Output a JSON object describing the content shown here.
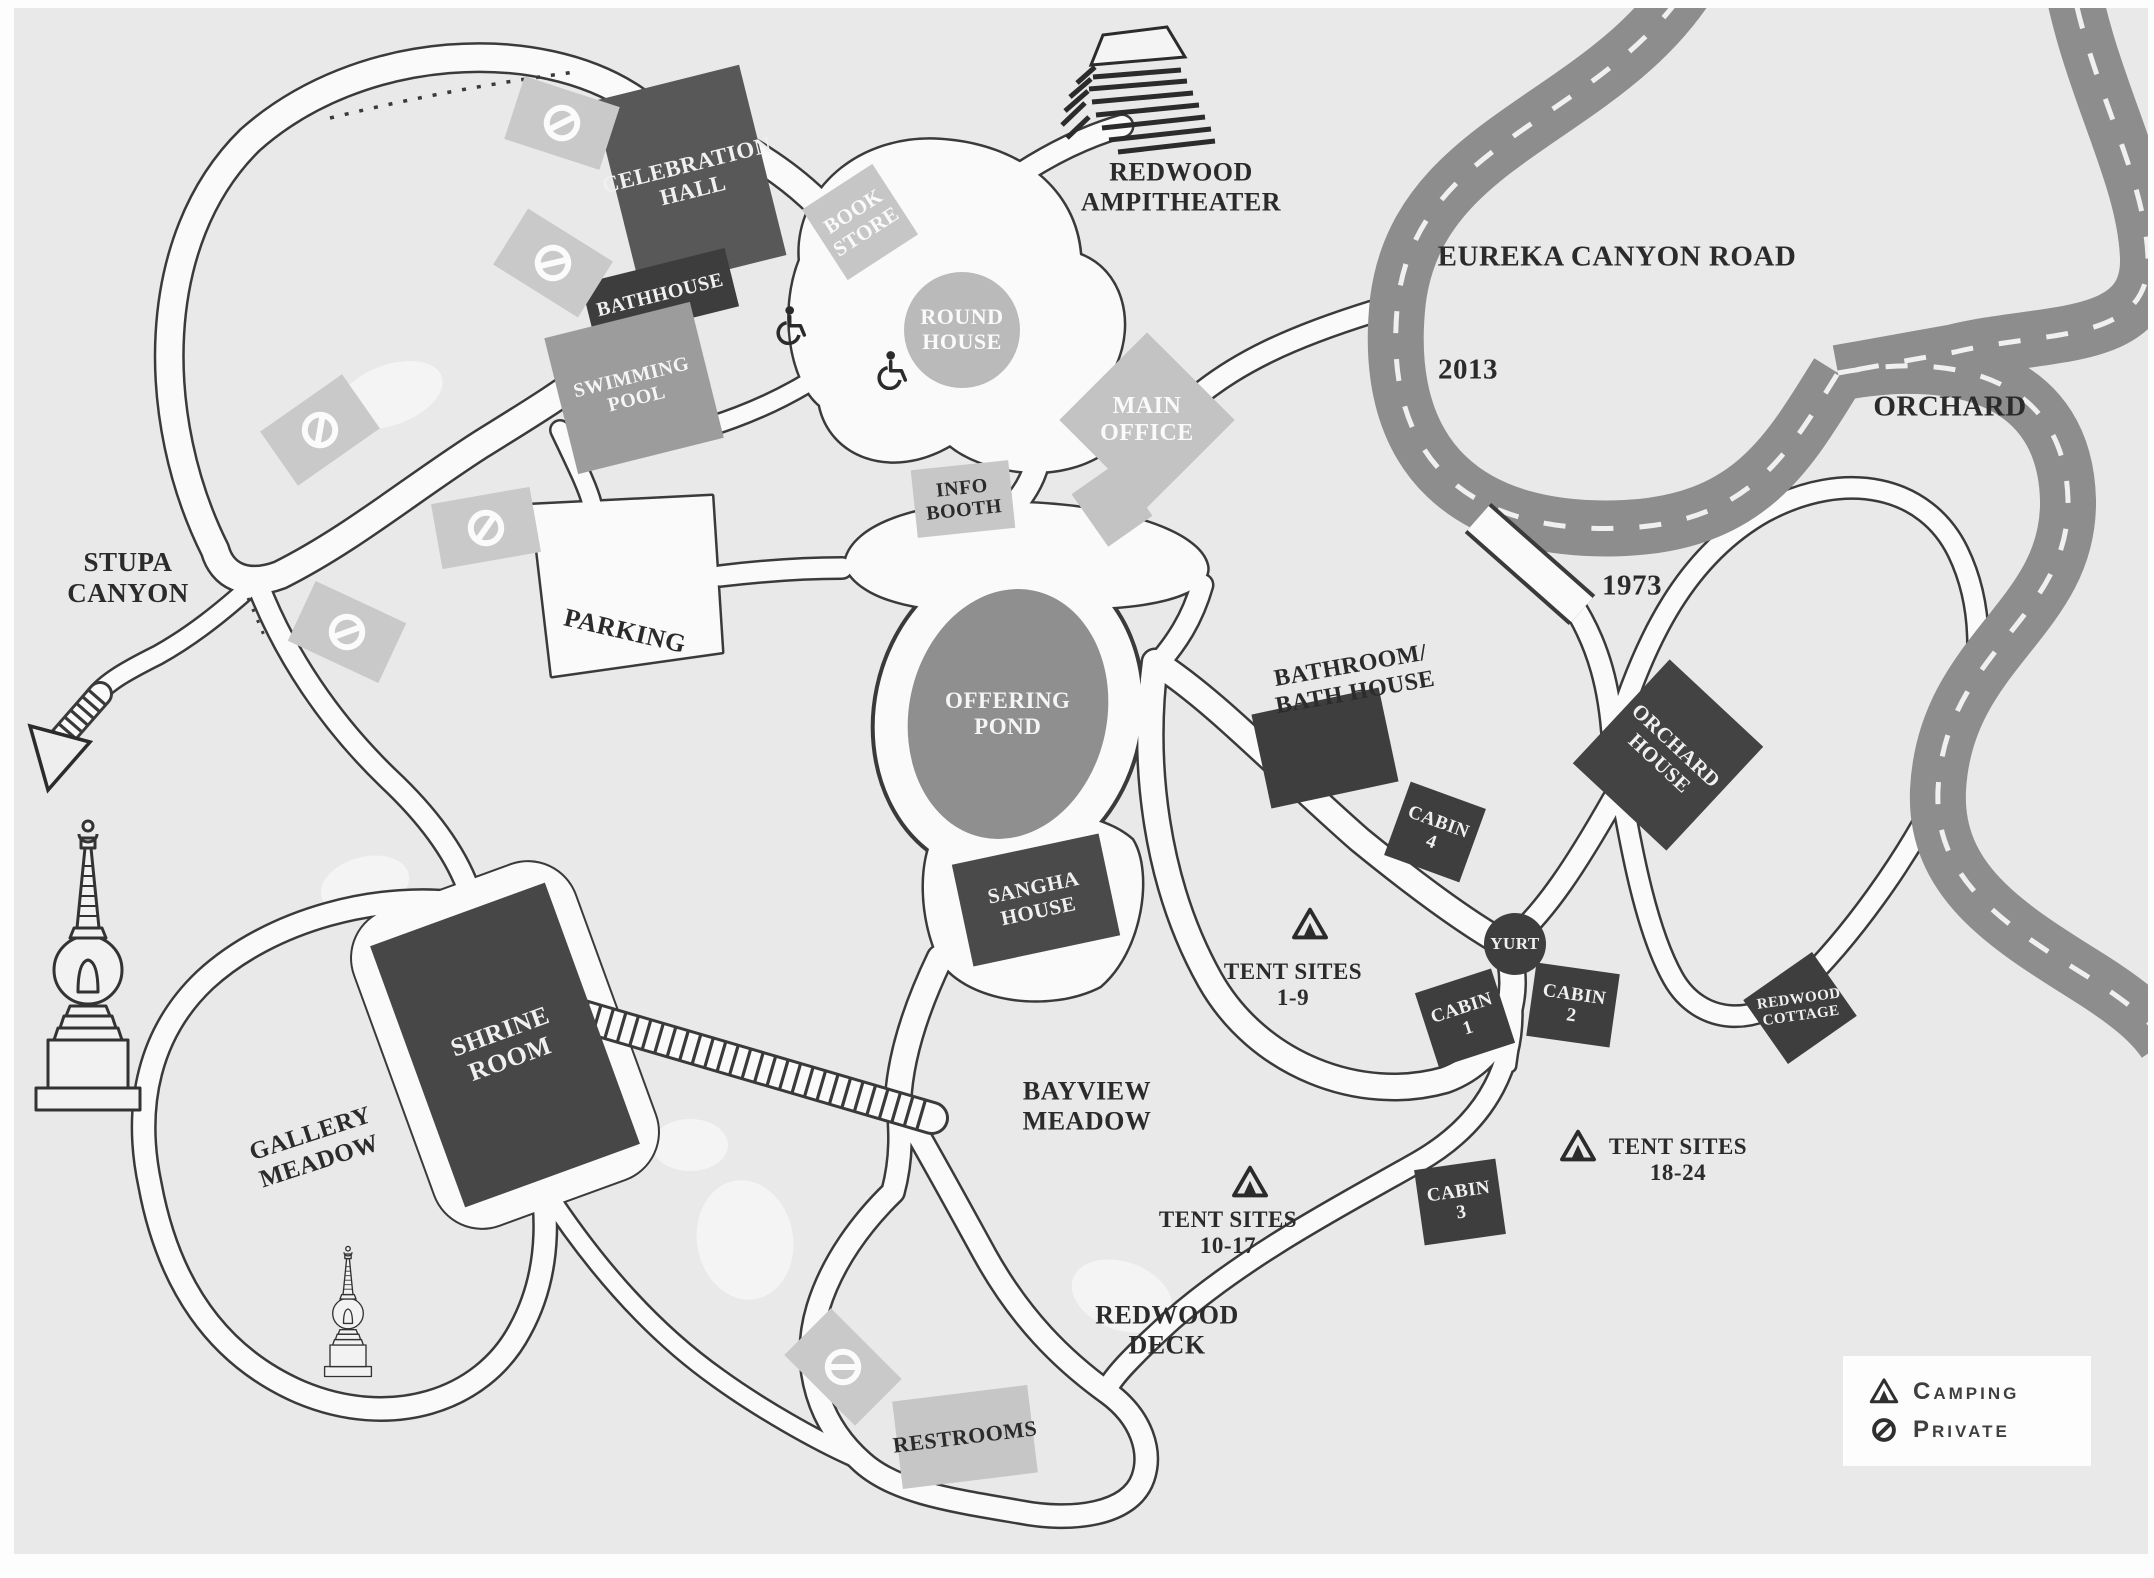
{
  "map": {
    "background_color": "#e9e9e9",
    "road": {
      "name": "EUREKA CANYON ROAD",
      "color": "#8d8d8d",
      "year_markers": [
        "2013",
        "1973"
      ]
    },
    "buildings": [
      {
        "name": "celebration-hall",
        "lines": [
          "CELEBRATION",
          "HALL"
        ],
        "x": 690,
        "y": 178,
        "w": 150,
        "h": 196,
        "rot": -14,
        "fill": "#585858",
        "text": "#f0f0f0",
        "fs": 23
      },
      {
        "name": "bathhouse",
        "lines": [
          "BATHHOUSE"
        ],
        "x": 660,
        "y": 295,
        "w": 148,
        "h": 60,
        "rot": -14,
        "fill": "#3d3d3d",
        "text": "#f0f0f0",
        "fs": 20
      },
      {
        "name": "swimming-pool",
        "lines": [
          "SWIMMING",
          "POOL"
        ],
        "x": 634,
        "y": 388,
        "w": 150,
        "h": 140,
        "rot": -14,
        "fill": "#9c9c9c",
        "text": "#f5f5f5",
        "fs": 20
      },
      {
        "name": "book-store",
        "lines": [
          "BOOK",
          "STORE"
        ],
        "x": 860,
        "y": 222,
        "w": 84,
        "h": 84,
        "rot": -33,
        "fill": "#c6c6c6",
        "text": "#fafafa",
        "fs": 21
      },
      {
        "name": "round-house",
        "shape": "circle",
        "lines": [
          "ROUND",
          "HOUSE"
        ],
        "x": 962,
        "y": 330,
        "w": 116,
        "h": 116,
        "rot": 0,
        "fill": "#bababa",
        "text": "#fafafa",
        "fs": 22
      },
      {
        "name": "main-office",
        "lines": [
          "MAIN",
          "OFFICE"
        ],
        "x": 1147,
        "y": 420,
        "w": 124,
        "h": 124,
        "rot": 45,
        "trot": -45,
        "fill": "#c3c3c3",
        "text": "#fafafa",
        "fs": 24
      },
      {
        "name": "office-annex",
        "lines": [],
        "x": 1112,
        "y": 505,
        "w": 54,
        "h": 64,
        "rot": -35,
        "fill": "#c3c3c3"
      },
      {
        "name": "info-booth",
        "lines": [
          "INFO",
          "BOOTH"
        ],
        "x": 963,
        "y": 499,
        "w": 98,
        "h": 68,
        "rot": -6,
        "fill": "#c7c7c7",
        "text": "#2b2b2b",
        "fs": 20
      },
      {
        "name": "offering-pond",
        "shape": "ellipse",
        "lines": [
          "OFFERING",
          "POND"
        ],
        "x": 1008,
        "y": 714,
        "w": 198,
        "h": 252,
        "rot": 12,
        "trot": -12,
        "fill": "#8f8f8f",
        "text": "#f5f5f5",
        "fs": 23
      },
      {
        "name": "sangha-house",
        "lines": [
          "SANGHA",
          "HOUSE"
        ],
        "x": 1036,
        "y": 900,
        "w": 150,
        "h": 104,
        "rot": -12,
        "fill": "#4a4a4a",
        "text": "#f0f0f0",
        "fs": 21
      },
      {
        "name": "bathroom-bath-house-building",
        "lines": [],
        "x": 1325,
        "y": 748,
        "w": 130,
        "h": 96,
        "rot": -12,
        "fill": "#3e3e3e"
      },
      {
        "name": "cabin-4",
        "lines": [
          "CABIN",
          "4"
        ],
        "x": 1435,
        "y": 832,
        "w": 80,
        "h": 78,
        "rot": 20,
        "fill": "#3e3e3e",
        "text": "#f0f0f0",
        "fs": 19
      },
      {
        "name": "yurt",
        "shape": "circle",
        "lines": [
          "YURT"
        ],
        "x": 1515,
        "y": 944,
        "w": 62,
        "h": 62,
        "rot": 0,
        "fill": "#3e3e3e",
        "text": "#f0f0f0",
        "fs": 17
      },
      {
        "name": "cabin-1",
        "lines": [
          "CABIN",
          "1"
        ],
        "x": 1465,
        "y": 1018,
        "w": 80,
        "h": 78,
        "rot": -18,
        "fill": "#3e3e3e",
        "text": "#f0f0f0",
        "fs": 19
      },
      {
        "name": "cabin-2",
        "lines": [
          "CABIN",
          "2"
        ],
        "x": 1573,
        "y": 1005,
        "w": 84,
        "h": 74,
        "rot": 8,
        "fill": "#3e3e3e",
        "text": "#f0f0f0",
        "fs": 19
      },
      {
        "name": "cabin-3",
        "lines": [
          "CABIN",
          "3"
        ],
        "x": 1460,
        "y": 1202,
        "w": 82,
        "h": 76,
        "rot": -8,
        "fill": "#3e3e3e",
        "text": "#f0f0f0",
        "fs": 19
      },
      {
        "name": "orchard-house",
        "lines": [
          "ORCHARD",
          "HOUSE"
        ],
        "x": 1668,
        "y": 755,
        "w": 142,
        "h": 128,
        "rot": -47,
        "trot": 90,
        "fill": "#434343",
        "text": "#f0f0f0",
        "fs": 21
      },
      {
        "name": "redwood-cottage",
        "lines": [
          "REDWOOD",
          "COTTAGE"
        ],
        "x": 1800,
        "y": 1008,
        "w": 84,
        "h": 78,
        "rot": -35,
        "trot": 27,
        "fill": "#3e3e3e",
        "text": "#f0f0f0",
        "fs": 15
      },
      {
        "name": "shrine-room",
        "lines": [
          "SHRINE",
          "ROOM"
        ],
        "x": 505,
        "y": 1045,
        "w": 186,
        "h": 278,
        "rot": -20,
        "fill": "#474747",
        "text": "#f0f0f0",
        "fs": 26
      },
      {
        "name": "restrooms",
        "lines": [
          "RESTROOMS"
        ],
        "x": 965,
        "y": 1437,
        "w": 136,
        "h": 88,
        "rot": -7,
        "fill": "#c6c6c6",
        "text": "#2b2b2b",
        "fs": 22
      }
    ],
    "labels": [
      {
        "name": "stupa-canyon",
        "lines": [
          "STUPA",
          "CANYON"
        ],
        "x": 128,
        "y": 578,
        "fs": 27
      },
      {
        "name": "parking",
        "lines": [
          "PARKING"
        ],
        "x": 625,
        "y": 631,
        "rot": 13,
        "fs": 26
      },
      {
        "name": "redwood-ampitheater",
        "lines": [
          "REDWOOD",
          "AMPITHEATER"
        ],
        "x": 1181,
        "y": 187,
        "fs": 26
      },
      {
        "name": "eureka-canyon-road",
        "lines": [
          "EUREKA CANYON ROAD"
        ],
        "x": 1617,
        "y": 257,
        "fs": 29
      },
      {
        "name": "marker-2013",
        "lines": [
          "2013"
        ],
        "x": 1468,
        "y": 370,
        "fs": 29
      },
      {
        "name": "marker-1973",
        "lines": [
          "1973"
        ],
        "x": 1632,
        "y": 586,
        "fs": 29
      },
      {
        "name": "orchard",
        "lines": [
          "ORCHARD"
        ],
        "x": 1950,
        "y": 407,
        "fs": 29
      },
      {
        "name": "bathroom-bath-house",
        "lines": [
          "BATHROOM/",
          "BATH HOUSE"
        ],
        "x": 1353,
        "y": 680,
        "rot": -10,
        "fs": 24
      },
      {
        "name": "gallery-meadow",
        "lines": [
          "GALLERY",
          "MEADOW"
        ],
        "x": 315,
        "y": 1148,
        "rot": -18,
        "fs": 25
      },
      {
        "name": "bayview-meadow",
        "lines": [
          "BAYVIEW",
          "MEADOW"
        ],
        "x": 1087,
        "y": 1106,
        "fs": 26
      },
      {
        "name": "redwood-deck",
        "lines": [
          "REDWOOD",
          "DECK"
        ],
        "x": 1167,
        "y": 1330,
        "fs": 26
      },
      {
        "name": "tent-sites-1-9",
        "lines": [
          "TENT SITES",
          "1-9"
        ],
        "x": 1293,
        "y": 985,
        "fs": 23
      },
      {
        "name": "tent-sites-10-17",
        "lines": [
          "TENT SITES",
          "10-17"
        ],
        "x": 1228,
        "y": 1233,
        "fs": 23
      },
      {
        "name": "tent-sites-18-24",
        "lines": [
          "TENT SITES",
          "18-24"
        ],
        "x": 1678,
        "y": 1160,
        "fs": 23
      }
    ],
    "tent_icons": [
      {
        "x": 1310,
        "y": 925
      },
      {
        "x": 1250,
        "y": 1183
      },
      {
        "x": 1578,
        "y": 1147
      }
    ],
    "accessible_icons": [
      {
        "x": 792,
        "y": 325
      },
      {
        "x": 893,
        "y": 370
      }
    ],
    "private_signs": [
      {
        "x": 562,
        "y": 123,
        "rot": 18
      },
      {
        "x": 553,
        "y": 263,
        "rot": 32
      },
      {
        "x": 320,
        "y": 430,
        "rot": -35
      },
      {
        "x": 486,
        "y": 528,
        "rot": -10
      },
      {
        "x": 347,
        "y": 632,
        "rot": 25
      },
      {
        "x": 843,
        "y": 1367,
        "rot": 45
      }
    ]
  },
  "legend": {
    "items": [
      {
        "icon": "tent-icon",
        "label": "Camping"
      },
      {
        "icon": "no-entry-icon",
        "label": "Private"
      }
    ]
  }
}
